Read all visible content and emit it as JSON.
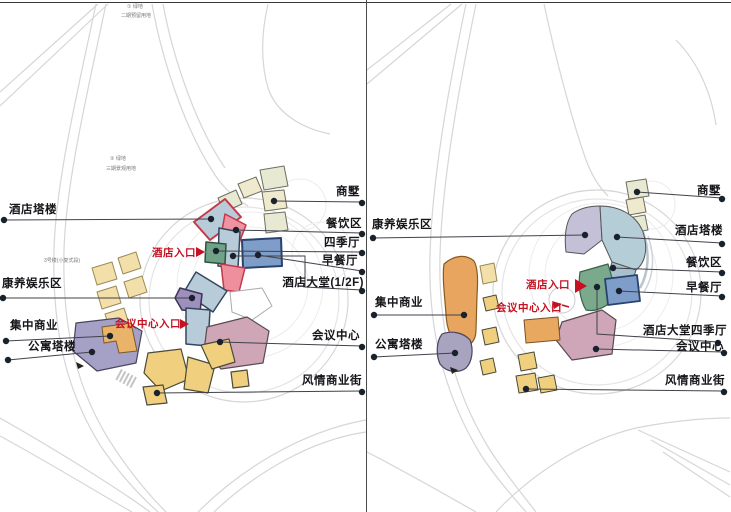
{
  "colors": {
    "building_blue": "#b7ccd8",
    "building_blue_border": "#33475e",
    "building_green": "#6fa287",
    "building_deep_blue": "#7e9dc8",
    "building_pink": "#ee8f9e",
    "building_pink_border": "#c4394a",
    "building_mauve": "#cfa6b6",
    "building_purple": "#9e90bd",
    "building_apartment_purple": "#a5a0c6",
    "building_orange": "#e8a55f",
    "building_yellow": "#f0cf7e",
    "building_cream": "#f3dfa9",
    "building_olive": "#e7e9d3",
    "label_color": "#15151a",
    "red_label": "#c51122",
    "leader_line": "#42424a",
    "road": "#d6d6d6"
  },
  "top_note": {
    "line1": "① 绿地",
    "line2": "二期预留用地"
  },
  "left_panel": {
    "labels": {
      "hotel_tower": "酒店塔楼",
      "wellness_zone": "康养娱乐区",
      "wellness_note": "3号楼(小复式段)",
      "central_commerce": "集中商业",
      "apartment_tower": "公寓塔楼",
      "villas": "商墅",
      "dining_zone": "餐饮区",
      "four_season_hall": "四季厅",
      "breakfast_hall": "早餐厅",
      "hotel_lobby": "酒店大堂(1/2F)",
      "conference_center": "会议中心",
      "commercial_street": "风情商业街"
    },
    "entrances": {
      "hotel": "酒店入口",
      "conference": "会议中心入口"
    },
    "site_note": {
      "line1": "② 绿地",
      "line2": "三期景观用地"
    }
  },
  "right_panel": {
    "labels": {
      "villas": "商墅",
      "hotel_tower": "酒店塔楼",
      "wellness_zone": "康养娱乐区",
      "dining_zone": "餐饮区",
      "breakfast_hall": "早餐厅",
      "hotel_lobby_four_season": "酒店大堂四季厅",
      "conference_center": "会议中心",
      "central_commerce": "集中商业",
      "apartment_tower": "公寓塔楼",
      "commercial_street": "风情商业街"
    },
    "entrances": {
      "hotel": "酒店入口",
      "conference": "会议中心入口"
    }
  }
}
